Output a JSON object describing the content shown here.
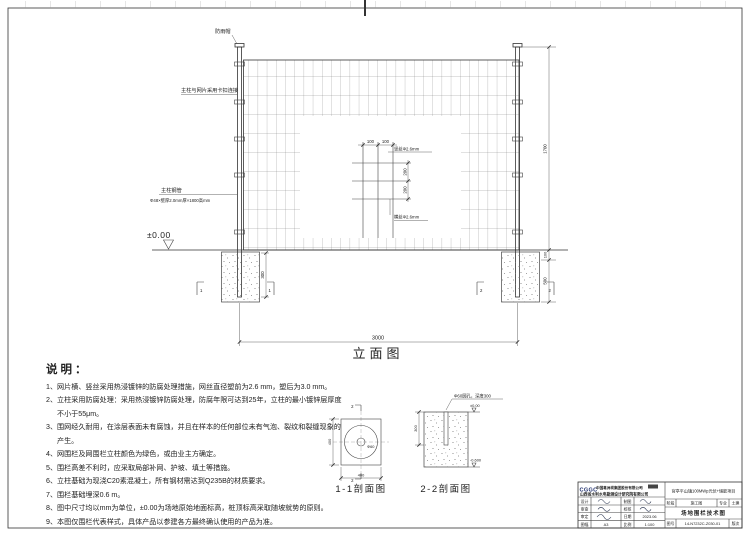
{
  "colors": {
    "paper": "#ffffff",
    "line": "#333333"
  },
  "elevation": {
    "caption": "立面图",
    "rain_cap_label": "防雨帽",
    "clip_label": "主柱与网片采用卡扣连接",
    "post_label": "主柱钢管",
    "post_spec": "Φ48×壁厚2.0mm厚×1800高mm",
    "ground_level": "±0.00",
    "dim_span": "3000",
    "dim_height": "1700",
    "dim_ground_offset": "100",
    "dim_foundation_depth": "500",
    "dim_embed": "300",
    "section_mark_left": "1",
    "section_mark_right": "2",
    "detail": {
      "dim_h_1": "100",
      "dim_h_2": "100",
      "dim_v_1": "200",
      "dim_v_2": "200",
      "vertical_wire_label": "竖丝Φ2.6mm",
      "horizontal_wire_label": "横丝Φ2.6mm"
    }
  },
  "notes": {
    "title": "说明：",
    "items": [
      "1、网片横、竖丝采用热浸镀锌的防腐处理措施，网丝直径塑前为2.6 mm，塑后为3.0 mm。",
      "2、立柱采用防腐处理：采用热浸镀锌防腐处理，防腐年限可达到25年，立柱的最小镀锌层厚度不小于55μm。",
      "3、围网经久耐用，在涂层表面未有腐蚀，并且在样本的任何部位未有气泡、裂纹和裂缝现象的产生。",
      "4、网围栏及网围栏立柱颜色为绿色，或由业主方确定。",
      "5、围栏高差不利时，应采取局部补网、护坡、填土等措施。",
      "6、立柱基础为现浇C20素混凝土，所有钢材需达到Q235B的材质要求。",
      "7、围栏基础埋深0.6 m。",
      "8、图中尺寸均以mm为单位，±0.00为场地原始地面标高，桩顶标高采取随坡就势的原则。",
      "9、本图仅围栏代表样式，具体产品以参建各方最终确认使用的产品为准。"
    ]
  },
  "sections": {
    "s11": {
      "caption": "1-1剖面图",
      "dim_width": "400",
      "dim_height": "400",
      "hole_dia": "Φ60",
      "mark": "2"
    },
    "s22": {
      "caption": "2-2剖面图",
      "hole_label": "Φ60圆孔，深度300",
      "level_top": "±0.00",
      "level_bottom": "-0.600",
      "dim_depth": "300"
    }
  },
  "titleblock": {
    "logo": "CGGC",
    "company_line1": "中国葛洲坝集团股份有限公司",
    "company_line2": "山西省水利水电勘测设计研究院有限公司",
    "left_rows": [
      {
        "l1": "设计",
        "l2": "制图"
      },
      {
        "l1": "审查",
        "l2": "校核"
      },
      {
        "l1": "审定",
        "l2": "日期",
        "v2": "2023.06"
      },
      {
        "l1": "图幅",
        "v1": "A3",
        "l2": "比例",
        "v2": "1:100"
      }
    ],
    "project": "官亭平山镇100MWp光伏+储能项目",
    "stage_label": "阶段",
    "stage": "施工图",
    "major_label": "专业",
    "major": "土建",
    "drawing_title": "场地围栏技术图",
    "number_label": "图号",
    "number": "14-N7232C-Z030-01",
    "rev_label": "版次"
  }
}
